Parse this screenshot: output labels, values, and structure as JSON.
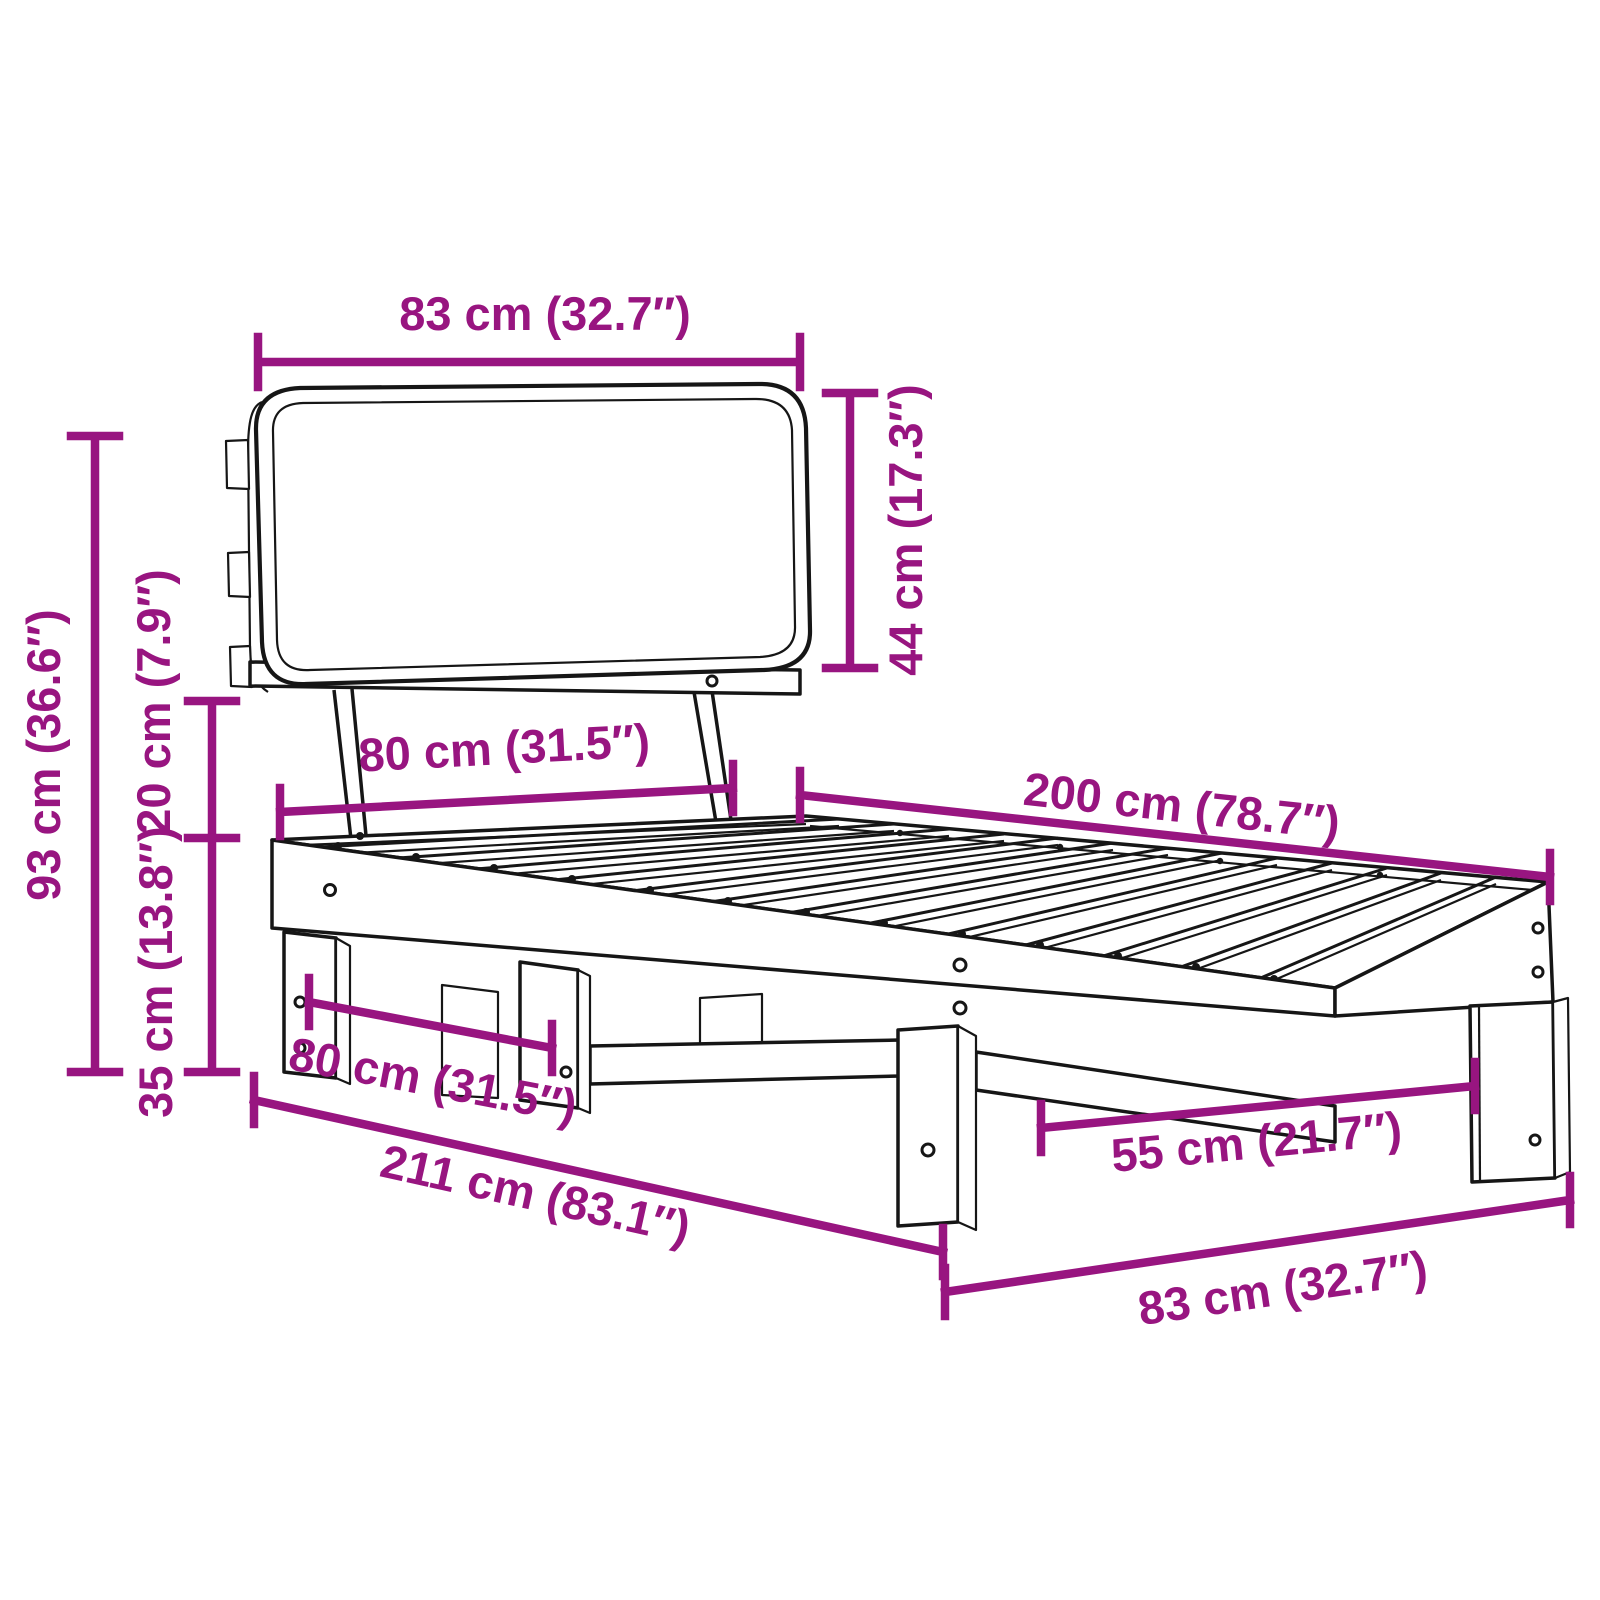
{
  "diagram": {
    "subject": "bed-frame-with-cushion-headboard-line-art",
    "units": [
      "cm",
      "in"
    ]
  },
  "colors": {
    "dimension_accent": "#981580",
    "line_art": "#161616",
    "background": "#ffffff"
  },
  "dimensions": {
    "headboard_width": {
      "label": "83 cm (32.7″)",
      "cm": 83,
      "inches": 32.7
    },
    "headboard_height": {
      "label": "44 cm (17.3″)",
      "cm": 44,
      "inches": 17.3
    },
    "headboard_total_height": {
      "label": "93 cm (36.6″)",
      "cm": 93,
      "inches": 36.6
    },
    "headboard_gap": {
      "label": "20 cm (7.9″)",
      "cm": 20,
      "inches": 7.9
    },
    "base_height": {
      "label": "35 cm (13.8″)",
      "cm": 35,
      "inches": 13.8
    },
    "bed_width": {
      "label": "80 cm (31.5″)",
      "cm": 80,
      "inches": 31.5
    },
    "bed_length": {
      "label": "200 cm (78.7″)",
      "cm": 200,
      "inches": 78.7
    },
    "leg_span_width": {
      "label": "80 cm (31.5″)",
      "cm": 80,
      "inches": 31.5
    },
    "total_length": {
      "label": "211 cm (83.1″)",
      "cm": 211,
      "inches": 83.1
    },
    "leg_span_length": {
      "label": "55 cm (21.7″)",
      "cm": 55,
      "inches": 21.7
    },
    "foot_width": {
      "label": "83 cm (32.7″)",
      "cm": 83,
      "inches": 32.7
    }
  }
}
